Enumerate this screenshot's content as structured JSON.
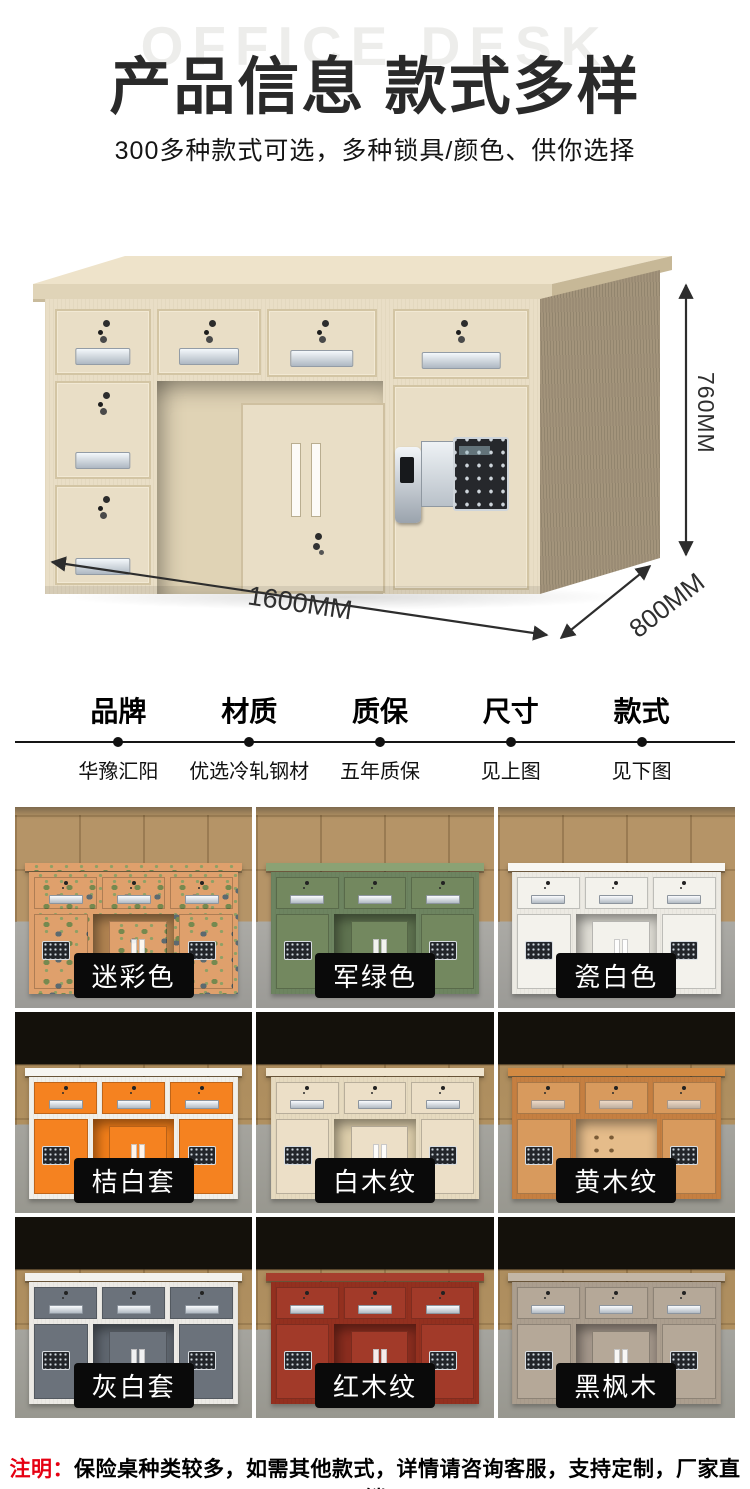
{
  "header": {
    "watermark": "OFFICE DESK",
    "title": "产品信息 款式多样",
    "subtitle": "300多种款式可选，多种锁具/颜色、供你选择"
  },
  "hero": {
    "dims": {
      "height": "760MM",
      "width": "1600MM",
      "depth": "800MM"
    },
    "colors": {
      "top": "#eee3ca",
      "edge": "#e0d4b8",
      "front": "#e9dec6",
      "side": "#a3947b",
      "kneebg": "#e0d3b5",
      "arrow": "#2d2d2d"
    }
  },
  "specs": {
    "items": [
      {
        "label": "品牌",
        "value": "华豫汇阳"
      },
      {
        "label": "材质",
        "value": "优选冷轧钢材"
      },
      {
        "label": "质保",
        "value": "五年质保"
      },
      {
        "label": "尺寸",
        "value": "见上图"
      },
      {
        "label": "款式",
        "value": "见下图"
      }
    ]
  },
  "grid": {
    "items": [
      {
        "label": "迷彩色",
        "camo": true,
        "colors": {
          "top": "#dfa06c",
          "frame": "#dfa06c",
          "panel": "#dfa06c",
          "inner": "#b08250"
        }
      },
      {
        "label": "军绿色",
        "colors": {
          "top": "#8ba274",
          "frame": "#6d8460",
          "panel": "#73885f",
          "inner": "#5f7350"
        }
      },
      {
        "label": "瓷白色",
        "colors": {
          "top": "#f8f7f3",
          "frame": "#eceae3",
          "panel": "#f3f2ec",
          "inner": "#dedcd4"
        }
      },
      {
        "label": "桔白套",
        "colors": {
          "top": "#f6f5f1",
          "frame": "#f1f0ea",
          "panel": "#f58220",
          "inner": "#ef7d1a"
        }
      },
      {
        "label": "白木纹",
        "colors": {
          "top": "#f0e5cf",
          "frame": "#e6dabf",
          "panel": "#ecdfc7",
          "inner": "#dccdaa"
        }
      },
      {
        "label": "黄木纹",
        "open": true,
        "colors": {
          "top": "#d28a43",
          "frame": "#c57f41",
          "panel": "#d89a5d",
          "inner": "#e5bc8a"
        }
      },
      {
        "label": "灰白套",
        "colors": {
          "top": "#f3f2ee",
          "frame": "#eceae5",
          "panel": "#6b727b",
          "inner": "#5f666f"
        }
      },
      {
        "label": "红木纹",
        "colors": {
          "top": "#a63f2e",
          "frame": "#93301f",
          "panel": "#a23a29",
          "inner": "#8b2d1f"
        }
      },
      {
        "label": "黑枫木",
        "colors": {
          "top": "#c3b6a6",
          "frame": "#ab9e8e",
          "panel": "#b5a898",
          "inner": "#a3968a"
        }
      }
    ]
  },
  "note": {
    "prefix": "注明：",
    "text": "保险桌种类较多，如需其他款式，详情请咨询客服，支持定制，厂家直销"
  },
  "colors": {
    "accent_red": "#e60012",
    "variant_label_bg": "#0a0a0a",
    "variant_label_text": "#ffffff",
    "title_text": "#2a2a2a",
    "watermark_text": "#ededeb"
  }
}
